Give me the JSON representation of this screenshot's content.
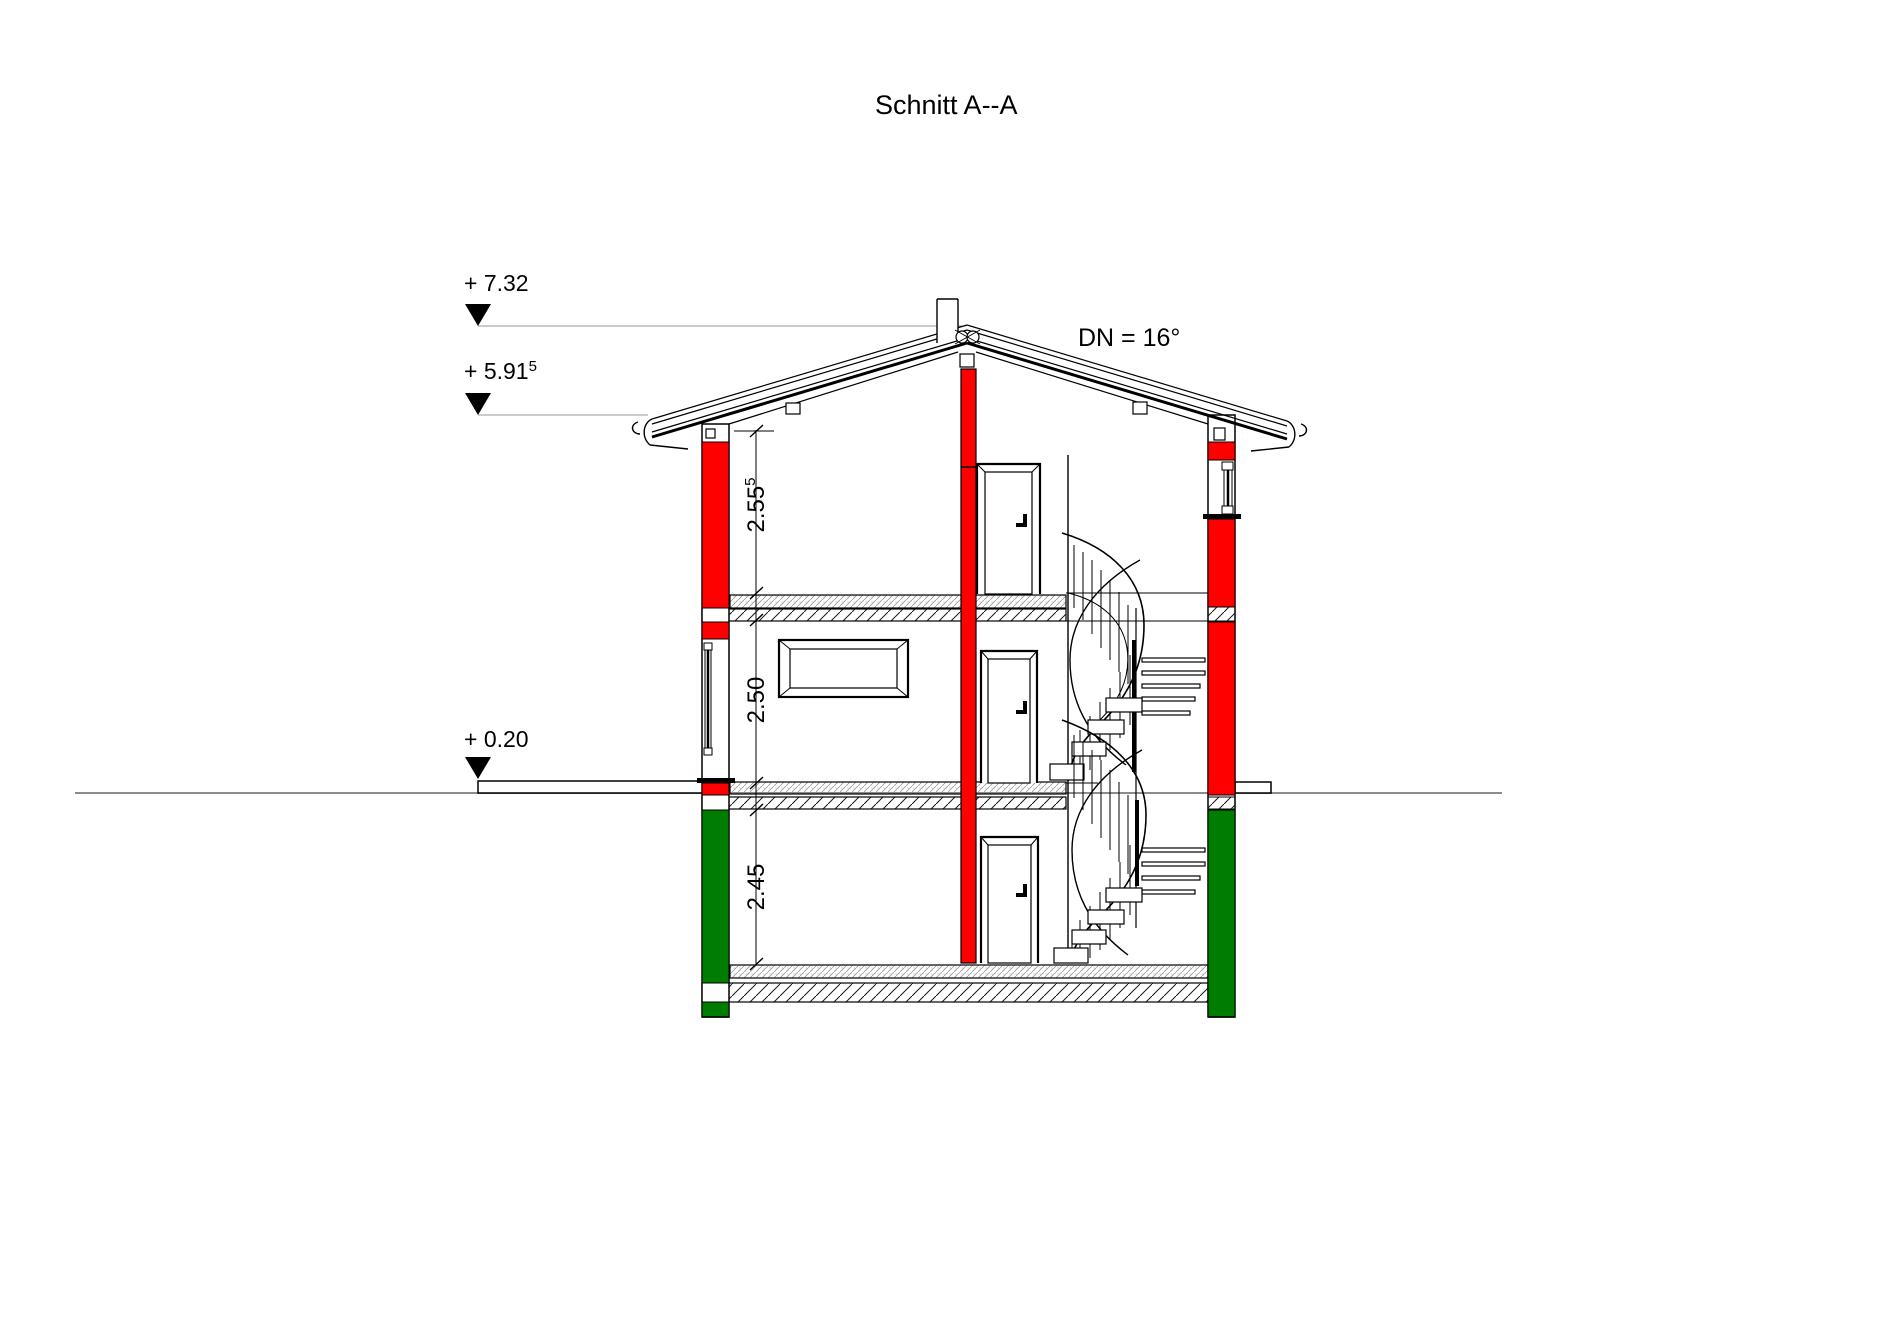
{
  "title": "Schnitt A--A",
  "roof": {
    "pitch_label": "DN = 16°"
  },
  "elevations": {
    "ridge": {
      "value": "+ 7.32",
      "sup": ""
    },
    "eave": {
      "value": "+ 5.91",
      "sup": "5"
    },
    "ground": {
      "value": "+ 0.20",
      "sup": ""
    }
  },
  "room_heights": {
    "attic": {
      "value": "2.55",
      "sup": "5"
    },
    "middle": {
      "value": "2.50",
      "sup": ""
    },
    "ground": {
      "value": "2.45",
      "sup": ""
    }
  },
  "colors": {
    "masonry": "#ff0000",
    "concrete_green": "#007d00",
    "ground_line": "#8c8c8c"
  }
}
